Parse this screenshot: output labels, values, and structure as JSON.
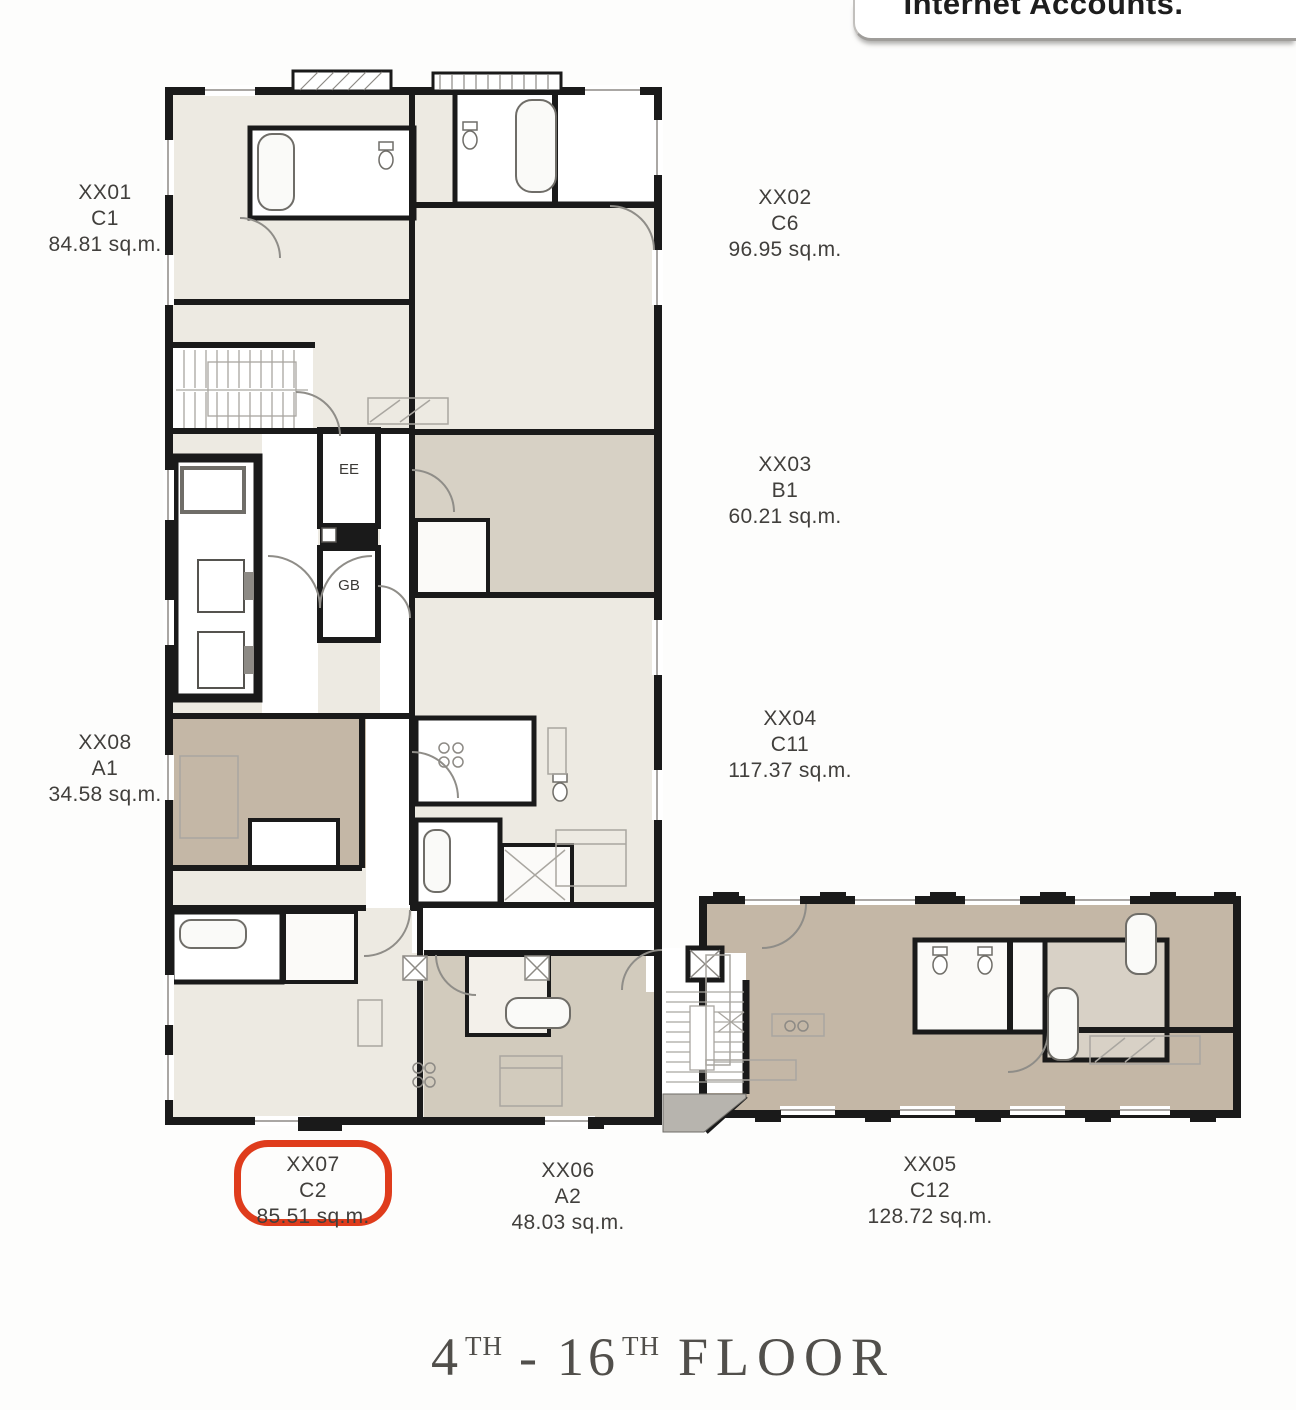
{
  "overlay_window": {
    "title": "Internet Accounts."
  },
  "plan": {
    "core_rooms": [
      {
        "label": "EE"
      },
      {
        "label": "GB"
      }
    ],
    "units": [
      {
        "id": "XX01",
        "type": "C1",
        "area": "84.81 sq.m.",
        "highlighted": false
      },
      {
        "id": "XX02",
        "type": "C6",
        "area": "96.95 sq.m.",
        "highlighted": false
      },
      {
        "id": "XX03",
        "type": "B1",
        "area": "60.21 sq.m.",
        "highlighted": false
      },
      {
        "id": "XX04",
        "type": "C11",
        "area": "117.37 sq.m.",
        "highlighted": false
      },
      {
        "id": "XX05",
        "type": "C12",
        "area": "128.72 sq.m.",
        "highlighted": false
      },
      {
        "id": "XX06",
        "type": "A2",
        "area": "48.03 sq.m.",
        "highlighted": false
      },
      {
        "id": "XX07",
        "type": "C2",
        "area": "85.51 sq.m.",
        "highlighted": true
      },
      {
        "id": "XX08",
        "type": "A1",
        "area": "34.58 sq.m.",
        "highlighted": false
      }
    ],
    "title": {
      "floor_from": "4",
      "ordinal_from": "TH",
      "separator": "-",
      "floor_to": "16",
      "ordinal_to": "TH",
      "word": "FLOOR"
    }
  },
  "colors": {
    "highlight_red": "#df3c1c",
    "wall_black": "#1a1a1a",
    "room_cream": "#edeae2",
    "room_greige": "#d7d1c5",
    "room_taupe": "#c4b7a6",
    "background": "#fdfdfc"
  }
}
